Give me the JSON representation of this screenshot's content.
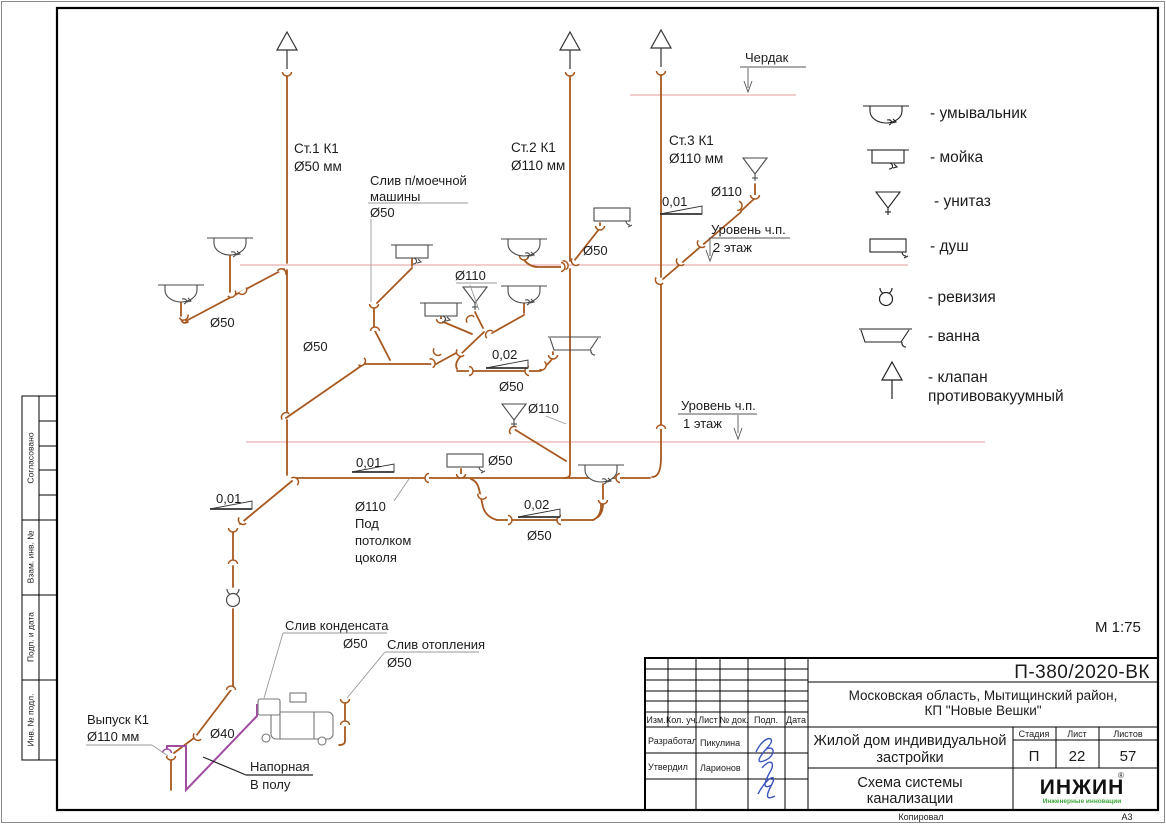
{
  "colors": {
    "pipe": "#A8581F",
    "pressure_pipe": "#A14BA1",
    "floor_line": "#E9AFAF",
    "logo_green": "#3DA639",
    "signature_blue": "#3B55C0"
  },
  "scale_label": "М 1:75",
  "footer": {
    "copied": "Копировал",
    "format": "А3"
  },
  "margin": {
    "agreed": "Согласовано",
    "replace_inv": "Взам. инв. №",
    "sign_date": "Подп. и дата",
    "inv_orig": "Инв. № подл."
  },
  "risers": {
    "r1a": "Ст.1 К1",
    "r1b": "Ø50 мм",
    "r2a": "Ст.2 К1",
    "r2b": "Ø110 мм",
    "r3a": "Ст.3 К1",
    "r3b": "Ø110 мм"
  },
  "levels": {
    "attic": "Чердак",
    "l2a": "Уровень ч.п.",
    "l2b": "2 этаж",
    "l1a": "Уровень ч.п.",
    "l1b": "1 этаж"
  },
  "ann": {
    "dw1": "Слив п/моечной",
    "dw2": "машины",
    "dw3": "Ø50",
    "slope_st3": "0,01",
    "dia_st3": "Ø110",
    "dia_sh2": "Ø50",
    "dia_wc2": "Ø110",
    "dia_left": "Ø50",
    "dia_diag": "Ø50",
    "slope_loop2": "0,02",
    "dia_loop2": "Ø50",
    "dia_wc1": "Ø110",
    "slope_coll": "0,01",
    "dia_sh1": "Ø50",
    "slope_loop1": "0,02",
    "dia_loop1": "Ø50",
    "slope_drop": "0,01",
    "ceil1": "Ø110",
    "ceil2": "Под",
    "ceil3": "потолком",
    "ceil4": "цоколя",
    "cond1": "Слив конденсата",
    "cond2": "Ø50",
    "heat1": "Слив отопления",
    "heat2": "Ø50",
    "out1": "Выпуск К1",
    "out2": "Ø110 мм",
    "dia40": "Ø40",
    "press1": "Напорная",
    "press2": "В полу"
  },
  "legend": {
    "items": [
      {
        "icon": "washbasin-symbol",
        "label": "- умывальник"
      },
      {
        "icon": "sink-symbol",
        "label": "- мойка"
      },
      {
        "icon": "toilet-symbol",
        "label": "- унитаз"
      },
      {
        "icon": "shower-symbol",
        "label": "- душ"
      },
      {
        "icon": "revision-symbol",
        "label": "- ревизия"
      },
      {
        "icon": "bath-symbol",
        "label": "- ванна"
      },
      {
        "icon": "vacuum-valve-symbol",
        "label": "- клапан",
        "label2": "противовакуумный"
      }
    ]
  },
  "titleblock": {
    "doc_number": "П-380/2020-ВК",
    "address1": "Московская область, Мытищинский район,",
    "address2": "КП \"Новые Вешки\"",
    "h_izm": "Изм.",
    "h_kol": "Кол. уч.",
    "h_list": "Лист",
    "h_doc": "№ док.",
    "h_sign": "Подп.",
    "h_date": "Дата",
    "role1": "Разработал",
    "name1": "Пикулина",
    "role2": "Утвердил",
    "name2": "Ларионов",
    "object1": "Жилой дом индивидуальной",
    "object2": "застройки",
    "stage_h": "Стадия",
    "list_h": "Лист",
    "listov_h": "Листов",
    "stage": "П",
    "list": "22",
    "listov": "57",
    "title1": "Схема системы",
    "title2": "канализации",
    "logo": "ИНЖИН",
    "logo_reg": "®",
    "logo_sub": "Инженерные инновации"
  }
}
